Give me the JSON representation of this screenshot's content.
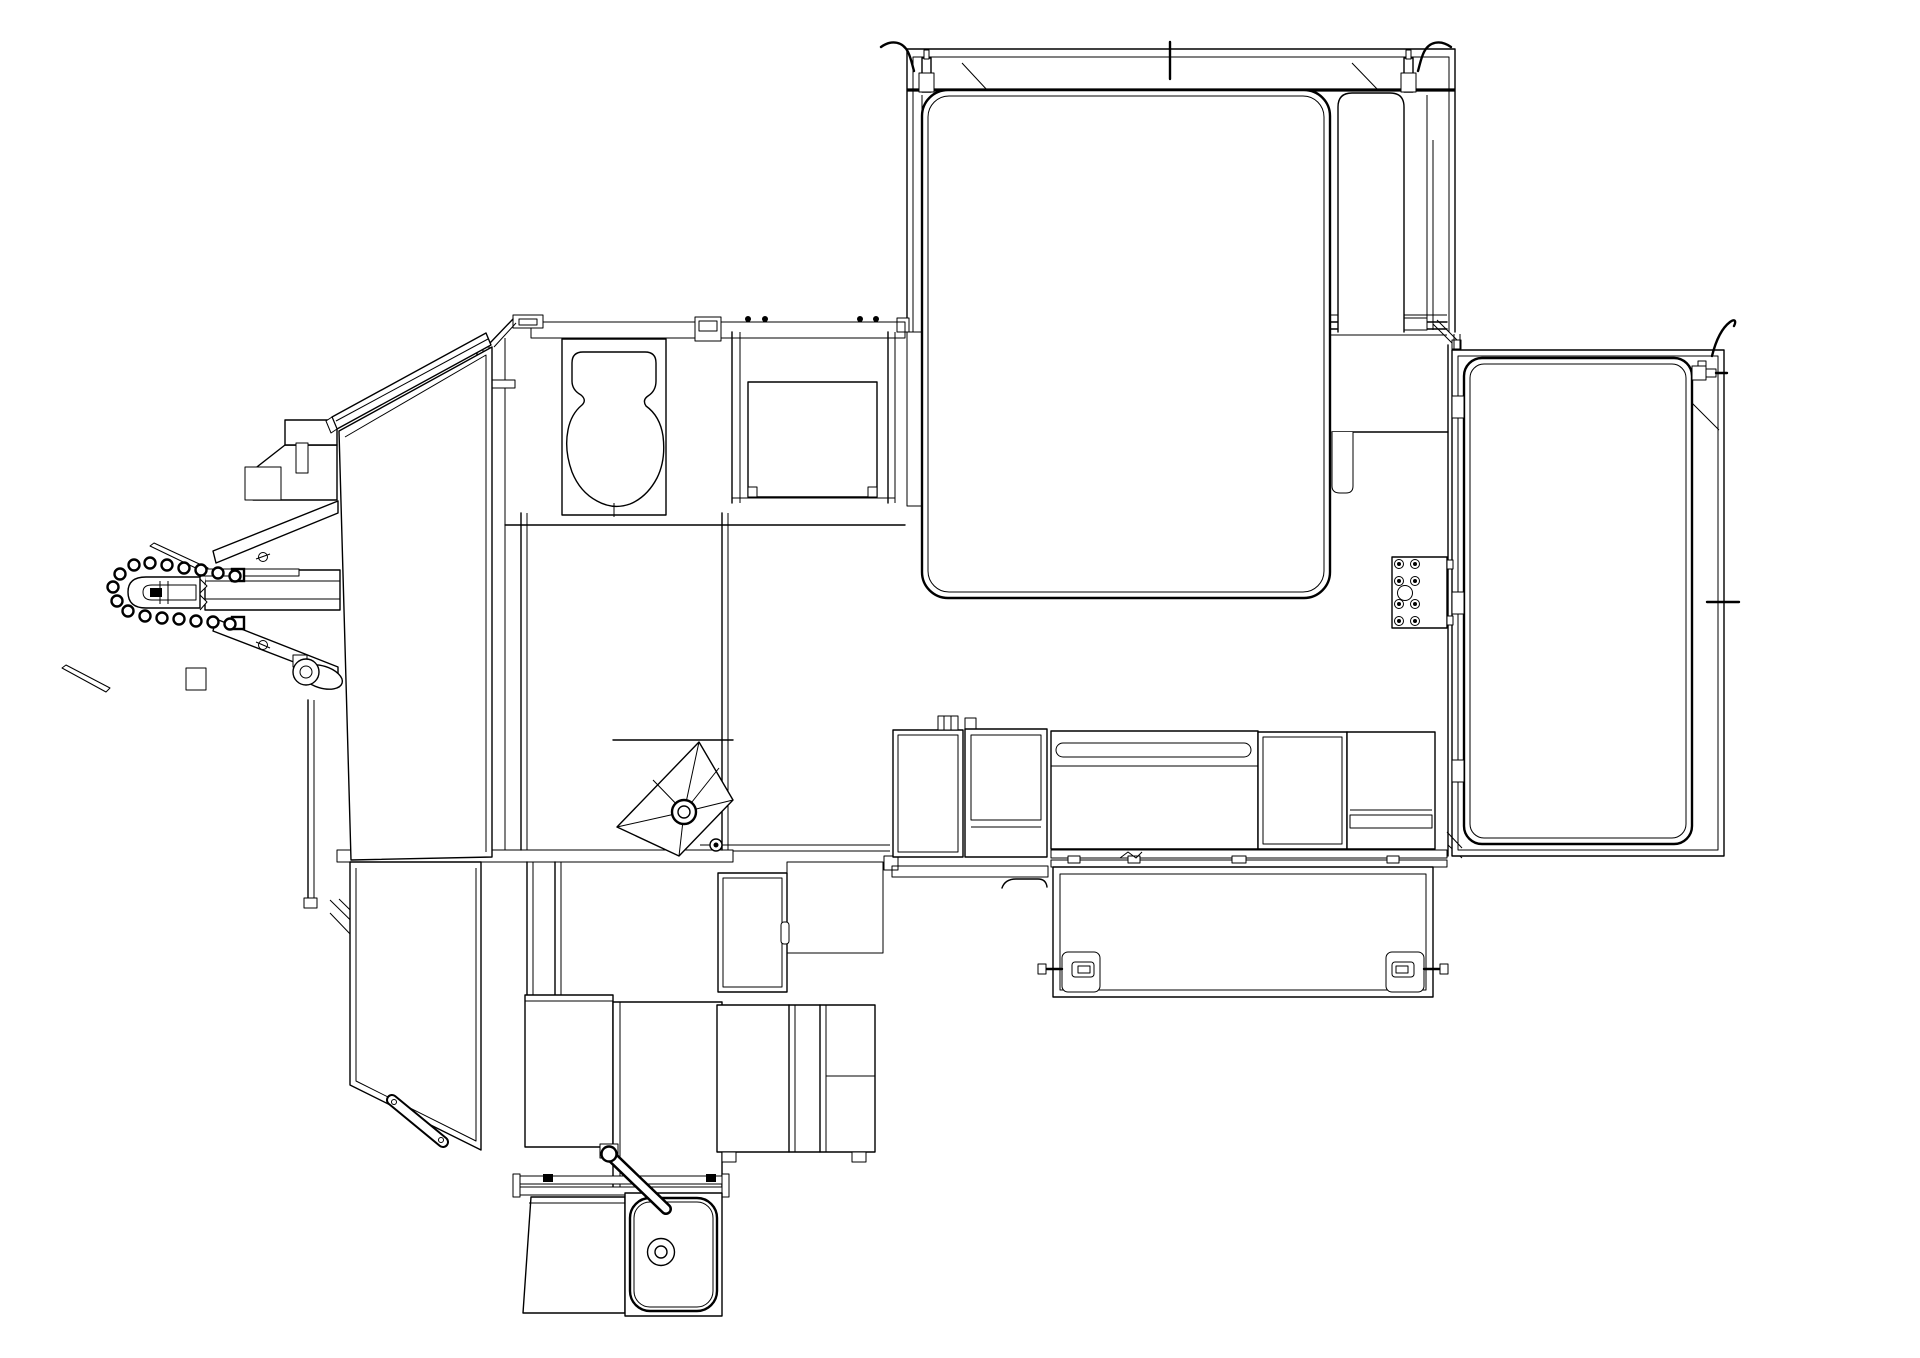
{
  "document": {
    "type": "CAD technical line drawing",
    "view": "plan (top) view",
    "subject": "Off-road camper trailer with fold-out panels, slide-out kitchen and drawbar",
    "background_color": "#ffffff",
    "line_color": "#000000"
  },
  "components": {
    "top_foldout": {
      "label": "Fold-out roof panel frame (rear)"
    },
    "mattress": {
      "label": "Fold-over bed mattress panel"
    },
    "side_flap": {
      "label": "Folded side flap panel"
    },
    "centerline_tick_top": {
      "label": "Centerline tick mark (top edge)"
    },
    "centerline_tick_right": {
      "label": "Centerline tick mark (right edge)"
    },
    "latch_pins": {
      "label": "Panel latch pins"
    },
    "pull_straps": {
      "label": "Canvas pull straps"
    },
    "body_shell": {
      "label": "Trailer body shell with tread-plate walls"
    },
    "tread_strips": {
      "label": "Sectioned wall strips (hatched)"
    },
    "water_tank": {
      "label": "Water tank (jerry-can) bay"
    },
    "fridge_hatch": {
      "label": "Hatched compartment (fridge / storage slide)"
    },
    "divider_wall": {
      "label": "Sectioned divider wall"
    },
    "bed_cross_member": {
      "label": "Bed platform cross member and bracket"
    },
    "shower_tray": {
      "label": "Corner shower tray with drain"
    },
    "counter_row": {
      "label": "Bench / storage compartment row"
    },
    "bench_slot": {
      "label": "Hatched bench slot"
    },
    "slide_rails": {
      "label": "Drawer slide rails"
    },
    "right_foldout": {
      "label": "Side fold-out door panel (right)"
    },
    "bolt_plate": {
      "label": "Bolted mounting plate"
    },
    "rear_door": {
      "label": "Drop-down tailgate door with T-latches"
    },
    "latch_pockets": {
      "label": "Recessed latch pockets"
    },
    "kitchen_foldout": {
      "label": "Slide-out kitchen unit"
    },
    "sink": {
      "label": "Stainless sink basin with drain"
    },
    "faucet": {
      "label": "Swivel faucet arm"
    },
    "storage_boxes": {
      "label": "Under-body storage boxes"
    },
    "stone_guard": {
      "label": "Angled front stone-guard panel (open)"
    },
    "side_door": {
      "label": "Open side access door with grab handle"
    },
    "drawbar": {
      "label": "Drawbar / A-frame"
    },
    "coupling": {
      "label": "Off-road hitch coupling"
    },
    "safety_chains": {
      "label": "Safety chain loop"
    },
    "jockey_wheel": {
      "label": "Swivel jockey wheel"
    }
  }
}
